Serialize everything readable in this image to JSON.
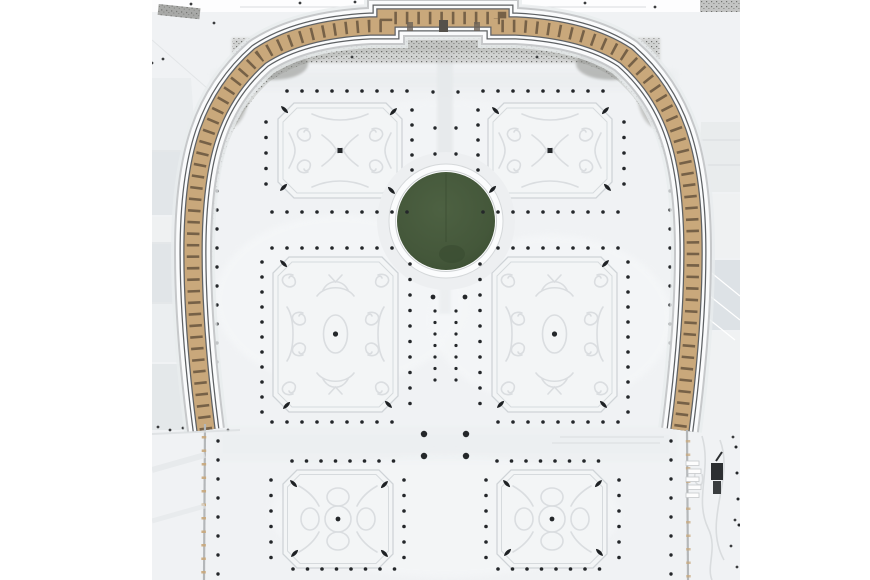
{
  "scene": {
    "subject": "aerial-winter-view-palace-parterre-garden",
    "colors": {
      "margin_white": "#ffffff",
      "snow_base": "#f0f2f4",
      "snow_bright": "#f6f8f9",
      "snow_shadow": "#e7eaec",
      "roof_light": "#eceef0",
      "roof_band": "#e3e6e9",
      "roof_hatch": "#dde2e6",
      "parapet_dark": "#5e6164",
      "parapet_snow": "#fafbfc",
      "outer_edge_gray": "#c6c8ca",
      "halo_snow": "#e9ecee",
      "facade_tan": "#c9a87b",
      "facade_window": "#6d5941",
      "gravel": "#b2b3b0",
      "gravel_dark": "#8e8f8b",
      "pond_rim": "#fbfcfd",
      "pond_green": "#46593c",
      "pond_green_dark": "#3c4f33",
      "bed_fill": "#f3f5f6",
      "bed_border": "#cfd3d7",
      "bed_pattern": "#d9dce0",
      "tree_dot": "#24272a",
      "cone_dark": "#1e2124",
      "machine_dark": "#2c2f31",
      "wall_gray": "#b4b7b9",
      "speck_dark": "#3a3c3e"
    },
    "photo": {
      "left": 152,
      "top": 0,
      "width": 588,
      "height": 580
    },
    "pond": {
      "cx": 446,
      "cy": 221,
      "r": 49,
      "rim_r": 57,
      "halo_r": 69
    },
    "tree_rows": [
      [
        287,
        91,
        15,
        0,
        9,
        1.8
      ],
      [
        272,
        212,
        15,
        0,
        10,
        1.8
      ],
      [
        266,
        122,
        0,
        15.5,
        5,
        1.8
      ],
      [
        412,
        110,
        0,
        15,
        5,
        1.8
      ],
      [
        483,
        91,
        15,
        0,
        9,
        1.8
      ],
      [
        483,
        212,
        15,
        0,
        10,
        1.8
      ],
      [
        478,
        110,
        0,
        15,
        5,
        1.8
      ],
      [
        624,
        122,
        0,
        15.5,
        5,
        1.8
      ],
      [
        272,
        248,
        15,
        0,
        9,
        1.8
      ],
      [
        272,
        422,
        15,
        0,
        9,
        1.8
      ],
      [
        262,
        262,
        0,
        15,
        11,
        1.8
      ],
      [
        410,
        264,
        0,
        15.5,
        10,
        1.8
      ],
      [
        498,
        248,
        15,
        0,
        9,
        1.8
      ],
      [
        498,
        422,
        15,
        0,
        9,
        1.8
      ],
      [
        480,
        264,
        0,
        15.5,
        10,
        1.8
      ],
      [
        628,
        262,
        0,
        15,
        11,
        1.8
      ],
      [
        435,
        311,
        0,
        11.5,
        7,
        1.6
      ],
      [
        456,
        311,
        0,
        11.5,
        7,
        1.6
      ],
      [
        435,
        128,
        0,
        26,
        2,
        1.7
      ],
      [
        456,
        128,
        0,
        26,
        2,
        1.7
      ],
      [
        433,
        92,
        25,
        0,
        2,
        1.7
      ],
      [
        433,
        297,
        32,
        0,
        2,
        2.4
      ],
      [
        424,
        434,
        42,
        0,
        2,
        3.2
      ],
      [
        424,
        456,
        42,
        0,
        2,
        3.2
      ],
      [
        292,
        461,
        14.5,
        0,
        8,
        1.8
      ],
      [
        293,
        569,
        14.5,
        0,
        8,
        1.8
      ],
      [
        271,
        480,
        0,
        15.5,
        6,
        1.8
      ],
      [
        404,
        480,
        0,
        15.5,
        6,
        1.8
      ],
      [
        497,
        461,
        14.5,
        0,
        8,
        1.8
      ],
      [
        498,
        569,
        14.5,
        0,
        8,
        1.8
      ],
      [
        486,
        480,
        0,
        15.5,
        6,
        1.8
      ],
      [
        619,
        480,
        0,
        15.5,
        6,
        1.8
      ],
      [
        217,
        96,
        0,
        19,
        18,
        1.7
      ],
      [
        218,
        441,
        0,
        19,
        8,
        1.7
      ],
      [
        670,
        96,
        0,
        19,
        18,
        1.7
      ],
      [
        671,
        441,
        0,
        19,
        8,
        1.7
      ],
      [
        736,
        447,
        1,
        26,
        4,
        1.5
      ]
    ],
    "cones": [
      [
        281,
        106,
        45
      ],
      [
        397,
        108,
        135
      ],
      [
        280,
        191,
        -45
      ],
      [
        395,
        194,
        -135
      ],
      [
        492,
        107,
        45
      ],
      [
        609,
        107,
        135
      ],
      [
        489,
        193,
        -45
      ],
      [
        611,
        191,
        -135
      ],
      [
        280,
        260,
        45
      ],
      [
        283,
        409,
        -45
      ],
      [
        392,
        408,
        -135
      ],
      [
        609,
        260,
        135
      ],
      [
        497,
        408,
        -45
      ],
      [
        607,
        408,
        -135
      ],
      [
        290,
        480,
        45
      ],
      [
        388,
        481,
        135
      ],
      [
        291,
        557,
        -45
      ],
      [
        388,
        557,
        -135
      ],
      [
        503,
        480,
        45
      ],
      [
        602,
        480,
        135
      ],
      [
        504,
        556,
        -45
      ],
      [
        603,
        556,
        -135
      ]
    ],
    "specks": [
      [
        191,
        4
      ],
      [
        214,
        23
      ],
      [
        163,
        59
      ],
      [
        152,
        63
      ],
      [
        300,
        3
      ],
      [
        355,
        2
      ],
      [
        517,
        2
      ],
      [
        585,
        3
      ],
      [
        655,
        7
      ],
      [
        268,
        33
      ],
      [
        618,
        33
      ],
      [
        352,
        57
      ],
      [
        537,
        57
      ],
      [
        149,
        428
      ],
      [
        158,
        427
      ],
      [
        170,
        430
      ],
      [
        183,
        428
      ],
      [
        196,
        429
      ],
      [
        228,
        430
      ],
      [
        733,
        437
      ],
      [
        735,
        520
      ],
      [
        731,
        546
      ],
      [
        737,
        567
      ]
    ]
  }
}
